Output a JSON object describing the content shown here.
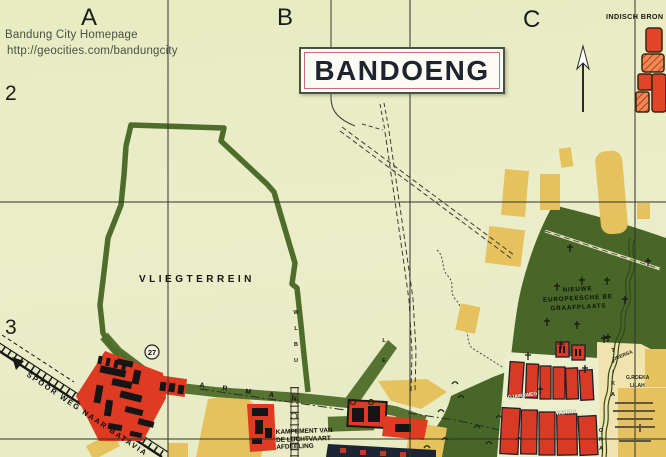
{
  "header": {
    "line1": "Bandung City Homepage",
    "line2": "http://geocities.com/bandungcity"
  },
  "grid": {
    "col_a": "A",
    "col_b": "B",
    "col_c": "C",
    "row_2": "2",
    "row_3": "3"
  },
  "title": "BANDOENG",
  "corner_label": "INDISCH BRON",
  "map_labels": {
    "airfield": "VLIEGTERREIN",
    "railway": "SPOOR WEG NAAR BATAVIA",
    "marker": "27",
    "kampement_line1": "KAMPEMENT VAN",
    "kampement_line2": "DE LUCHTVAART",
    "kampement_line3": "AFDEELING",
    "cemetery_line1": "NIEUWE",
    "cemetery_line2": "EUROPEESCHE BE",
    "cemetery_line3": "GRAAFPLAATS",
    "road_letters": "ARMAN",
    "airfield_edge_letters": "WLBU",
    "side_road_letters": "LE",
    "river_letters": "TJIKA",
    "river_letters2": "ONA",
    "street_1": "DJAWAWEG",
    "street_2": "WETAN",
    "yellow_area_1": "ODERSA",
    "yellow_area_2": "G.ROEKA",
    "yellow_area_3": "LILAH"
  },
  "colors": {
    "background": "#e9ecc6",
    "olive_road": "#567331",
    "dark_green": "#486627",
    "red": "#df3a22",
    "yellow": "#e5c25d",
    "pale_yellow": "#f0e3ae",
    "title_pink": "#c96a86",
    "grid_line": "#32322c",
    "navy": "#1d2433"
  }
}
